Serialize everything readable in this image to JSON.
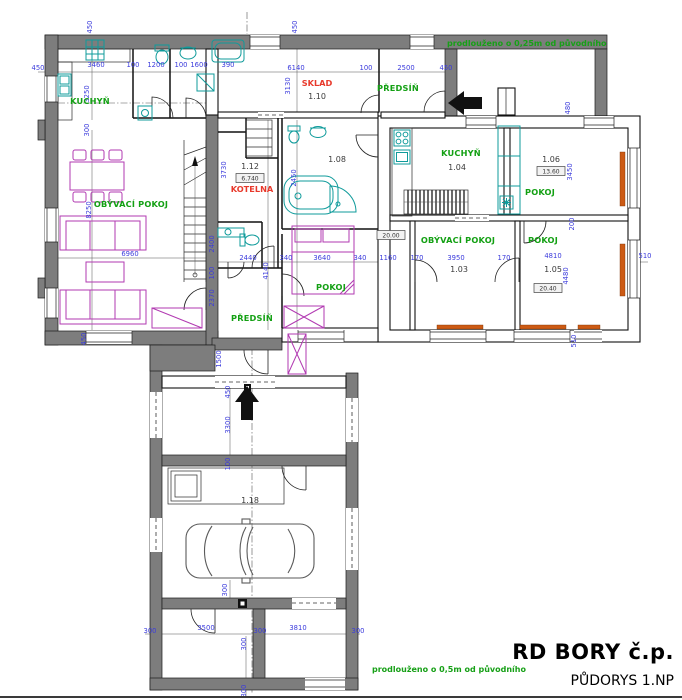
{
  "title_block": {
    "project": "RD BORY č.p.",
    "drawing": "PŮDORYS 1.NP"
  },
  "notes": [
    {
      "t": "prodlouženo o 0,25m od původního",
      "x": 447,
      "y": 46
    },
    {
      "t": "prodlouženo o 0,5m od původního",
      "x": 372,
      "y": 672
    }
  ],
  "room_labels": [
    {
      "t": "KUCHYŇ",
      "x": 90,
      "y": 104
    },
    {
      "t": "OBÝVACÍ POKOJ",
      "x": 131,
      "y": 207
    },
    {
      "t": "PŘEDSÍŇ",
      "x": 398,
      "y": 91
    },
    {
      "t": "PŘEDSÍŇ",
      "x": 252,
      "y": 321
    },
    {
      "t": "POKOJ",
      "x": 331,
      "y": 290
    },
    {
      "t": "KUCHYŇ",
      "x": 461,
      "y": 156
    },
    {
      "t": "POKOJ",
      "x": 540,
      "y": 195
    },
    {
      "t": "OBÝVACÍ POKOJ",
      "x": 458,
      "y": 243
    },
    {
      "t": "POKOJ",
      "x": 543,
      "y": 243
    }
  ],
  "special_labels": [
    {
      "t": "SKLAD",
      "x": 317,
      "y": 86
    },
    {
      "t": "KOTELNA",
      "x": 252,
      "y": 192
    }
  ],
  "room_numbers": [
    {
      "t": "1.10",
      "x": 317,
      "y": 99
    },
    {
      "t": "1.12",
      "x": 250,
      "y": 169
    },
    {
      "t": "1.08",
      "x": 337,
      "y": 162
    },
    {
      "t": "1.04",
      "x": 457,
      "y": 170
    },
    {
      "t": "1.06",
      "x": 551,
      "y": 162
    },
    {
      "t": "1.03",
      "x": 459,
      "y": 272
    },
    {
      "t": "1.05",
      "x": 553,
      "y": 272
    },
    {
      "t": "1.18",
      "x": 250,
      "y": 503
    }
  ],
  "area_boxes": [
    {
      "t": "6.740",
      "x": 250,
      "y": 180
    },
    {
      "t": "13.60",
      "x": 551,
      "y": 173
    },
    {
      "t": "20.40",
      "x": 548,
      "y": 290
    },
    {
      "t": "20.00",
      "x": 391,
      "y": 237
    }
  ],
  "dimensions": [
    {
      "t": "450",
      "x": 38,
      "y": 70
    },
    {
      "t": "3460",
      "x": 96,
      "y": 67
    },
    {
      "t": "100",
      "x": 133,
      "y": 67
    },
    {
      "t": "1200",
      "x": 156,
      "y": 67
    },
    {
      "t": "100",
      "x": 181,
      "y": 67
    },
    {
      "t": "1600",
      "x": 199,
      "y": 67
    },
    {
      "t": "390",
      "x": 228,
      "y": 67
    },
    {
      "t": "6140",
      "x": 296,
      "y": 70
    },
    {
      "t": "100",
      "x": 366,
      "y": 70
    },
    {
      "t": "2500",
      "x": 406,
      "y": 70
    },
    {
      "t": "450",
      "x": 446,
      "y": 70
    },
    {
      "t": "450",
      "x": 92,
      "y": 27,
      "v": true
    },
    {
      "t": "450",
      "x": 297,
      "y": 27,
      "v": true
    },
    {
      "t": "3250",
      "x": 89,
      "y": 94,
      "v": true
    },
    {
      "t": "3130",
      "x": 290,
      "y": 86,
      "v": true
    },
    {
      "t": "300",
      "x": 89,
      "y": 130,
      "v": true
    },
    {
      "t": "8250",
      "x": 91,
      "y": 210,
      "v": true
    },
    {
      "t": "6960",
      "x": 130,
      "y": 256
    },
    {
      "t": "450",
      "x": 86,
      "y": 339,
      "v": true
    },
    {
      "t": "3730",
      "x": 226,
      "y": 170,
      "v": true
    },
    {
      "t": "2450",
      "x": 296,
      "y": 178,
      "v": true
    },
    {
      "t": "2400",
      "x": 214,
      "y": 244,
      "v": true
    },
    {
      "t": "100",
      "x": 214,
      "y": 273,
      "v": true
    },
    {
      "t": "2370",
      "x": 214,
      "y": 298,
      "v": true
    },
    {
      "t": "1500",
      "x": 221,
      "y": 359,
      "v": true
    },
    {
      "t": "4140",
      "x": 268,
      "y": 271,
      "v": true
    },
    {
      "t": "2440",
      "x": 248,
      "y": 260
    },
    {
      "t": "340",
      "x": 286,
      "y": 260
    },
    {
      "t": "3640",
      "x": 322,
      "y": 260
    },
    {
      "t": "340",
      "x": 360,
      "y": 260
    },
    {
      "t": "1160",
      "x": 388,
      "y": 260
    },
    {
      "t": "170",
      "x": 417,
      "y": 260
    },
    {
      "t": "3950",
      "x": 456,
      "y": 260
    },
    {
      "t": "170",
      "x": 504,
      "y": 260
    },
    {
      "t": "4810",
      "x": 553,
      "y": 258
    },
    {
      "t": "510",
      "x": 645,
      "y": 258
    },
    {
      "t": "3450",
      "x": 572,
      "y": 172,
      "v": true
    },
    {
      "t": "200",
      "x": 574,
      "y": 224,
      "v": true
    },
    {
      "t": "4480",
      "x": 568,
      "y": 276,
      "v": true
    },
    {
      "t": "510",
      "x": 576,
      "y": 341,
      "v": true
    },
    {
      "t": "480",
      "x": 570,
      "y": 108,
      "v": true
    },
    {
      "t": "450",
      "x": 230,
      "y": 392,
      "v": true
    },
    {
      "t": "3300",
      "x": 230,
      "y": 425,
      "v": true
    },
    {
      "t": "100",
      "x": 230,
      "y": 464,
      "v": true
    },
    {
      "t": "300",
      "x": 227,
      "y": 590,
      "v": true
    },
    {
      "t": "300",
      "x": 150,
      "y": 633
    },
    {
      "t": "3500",
      "x": 206,
      "y": 630
    },
    {
      "t": "300",
      "x": 260,
      "y": 633
    },
    {
      "t": "3810",
      "x": 298,
      "y": 630
    },
    {
      "t": "300",
      "x": 358,
      "y": 633
    },
    {
      "t": "300",
      "x": 246,
      "y": 644,
      "v": true
    },
    {
      "t": "300",
      "x": 246,
      "y": 691,
      "v": true
    }
  ],
  "colors": {
    "walls": "#7d7d7d",
    "dimension_text": "#3c3cdc",
    "room_label": "#13a013",
    "special_label": "#e8392b",
    "furniture": "#b23ab2",
    "fixtures": "#0f9b9b",
    "radiator": "#cc5a14"
  }
}
